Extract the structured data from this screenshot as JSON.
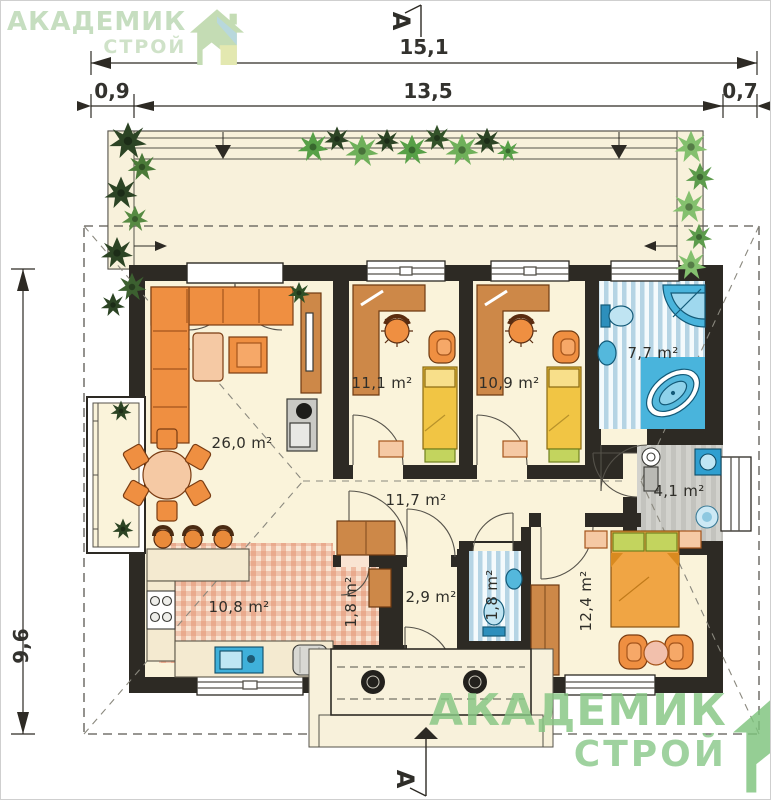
{
  "brand": {
    "line1": "АКАДЕМИК",
    "line2": "СТРОЙ"
  },
  "section_marker": {
    "label": "А"
  },
  "dimensions": {
    "total_width": "15,1",
    "left_offset": "0,9",
    "main_width": "13,5",
    "right_offset": "0,7",
    "depth": "9,6"
  },
  "rooms": {
    "living_room": "26,0 m²",
    "kitchen": "10,8 m²",
    "bedroom_1": "11,1 m²",
    "bedroom_2": "10,9 m²",
    "bathroom": "7,7 m²",
    "utility": "4,1 m²",
    "hallway": "11,7 m²",
    "pantry": "1,8 m²",
    "entry_hall": "2,9 m²",
    "wc": "1,8 m²",
    "bedroom_3": "12,4 m²"
  },
  "colors": {
    "brand_green": "#8cc98c",
    "brand_green_pale": "#c6dec0",
    "wall": "#2d2a24",
    "floor_cream": "#faf3da",
    "furniture_orange": "#ef8f41",
    "wood": "#cd8848",
    "bath_blue": "#3fb0da",
    "terrace_cream": "#f8f1db"
  }
}
